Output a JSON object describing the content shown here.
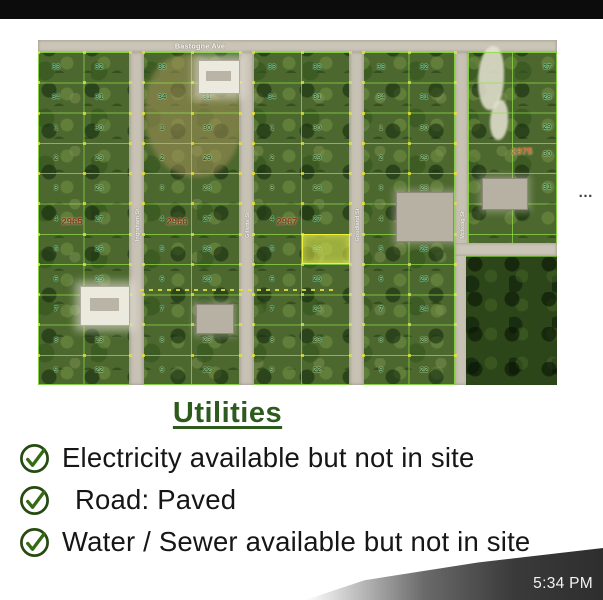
{
  "page": {
    "top_bar_color": "#0c0c0c",
    "background": "#ffffff",
    "timestamp": "5:34 PM"
  },
  "map": {
    "top_street": "Bastogne Ave",
    "vertical_streets": [
      "Ingraham St",
      "Gillette St",
      "Goodland St",
      "Mckeag St"
    ],
    "ellipsis": "…",
    "blocks": [
      {
        "label": "2965",
        "lots": [
          [
            "33",
            "32"
          ],
          [
            "34",
            "31"
          ],
          [
            "1",
            "30"
          ],
          [
            "2",
            "29"
          ],
          [
            "3",
            "28"
          ],
          [
            "4",
            "27"
          ],
          [
            "5",
            "26"
          ],
          [
            "6",
            "25"
          ],
          [
            "7",
            "24"
          ],
          [
            "8",
            "23"
          ],
          [
            "9",
            "22"
          ]
        ]
      },
      {
        "label": "2966",
        "lots": [
          [
            "33",
            "32"
          ],
          [
            "34",
            "31"
          ],
          [
            "1",
            "30"
          ],
          [
            "2",
            "29"
          ],
          [
            "3",
            "28"
          ],
          [
            "4",
            "27"
          ],
          [
            "5",
            "26"
          ],
          [
            "6",
            "25"
          ],
          [
            "7",
            "24"
          ],
          [
            "8",
            "23"
          ],
          [
            "9",
            "22"
          ]
        ]
      },
      {
        "label": "2967",
        "lots": [
          [
            "33",
            "32"
          ],
          [
            "34",
            "31"
          ],
          [
            "1",
            "30"
          ],
          [
            "2",
            "29"
          ],
          [
            "3",
            "28"
          ],
          [
            "4",
            "27"
          ],
          [
            "5",
            "26"
          ],
          [
            "6",
            "25"
          ],
          [
            "7",
            "24"
          ],
          [
            "8",
            "23"
          ],
          [
            "9",
            "22"
          ]
        ],
        "highlighted_lot": "26"
      },
      {
        "label": "2968",
        "lots": [
          [
            "33",
            "32"
          ],
          [
            "34",
            "31"
          ],
          [
            "1",
            "30"
          ],
          [
            "2",
            "29"
          ],
          [
            "3",
            "28"
          ],
          [
            "4",
            "27"
          ],
          [
            "5",
            "26"
          ],
          [
            "6",
            "25"
          ],
          [
            "7",
            "24"
          ],
          [
            "8",
            "23"
          ],
          [
            "9",
            "22"
          ]
        ]
      }
    ],
    "right_area": {
      "label": "2975",
      "lot_numbers": [
        "27",
        "28",
        "29",
        "30",
        "31",
        "24"
      ]
    },
    "colors": {
      "grid_line": "#91e146",
      "road": "#cbc5b7",
      "lot_number": "#1b5e36",
      "block_label": "#8a3a1a",
      "right_block_label": "#c06b32",
      "highlight_fill": "#dee84e",
      "highlight_border": "#eef040"
    }
  },
  "utilities": {
    "heading": "Utilities",
    "heading_color": "#2d5a1d",
    "items": [
      {
        "icon": "check-circle-icon",
        "text": "Electricity available but not in site"
      },
      {
        "icon": "check-circle-icon",
        "text": "Road: Paved"
      },
      {
        "icon": "check-circle-icon",
        "text": "Water / Sewer available but not in site"
      }
    ]
  }
}
